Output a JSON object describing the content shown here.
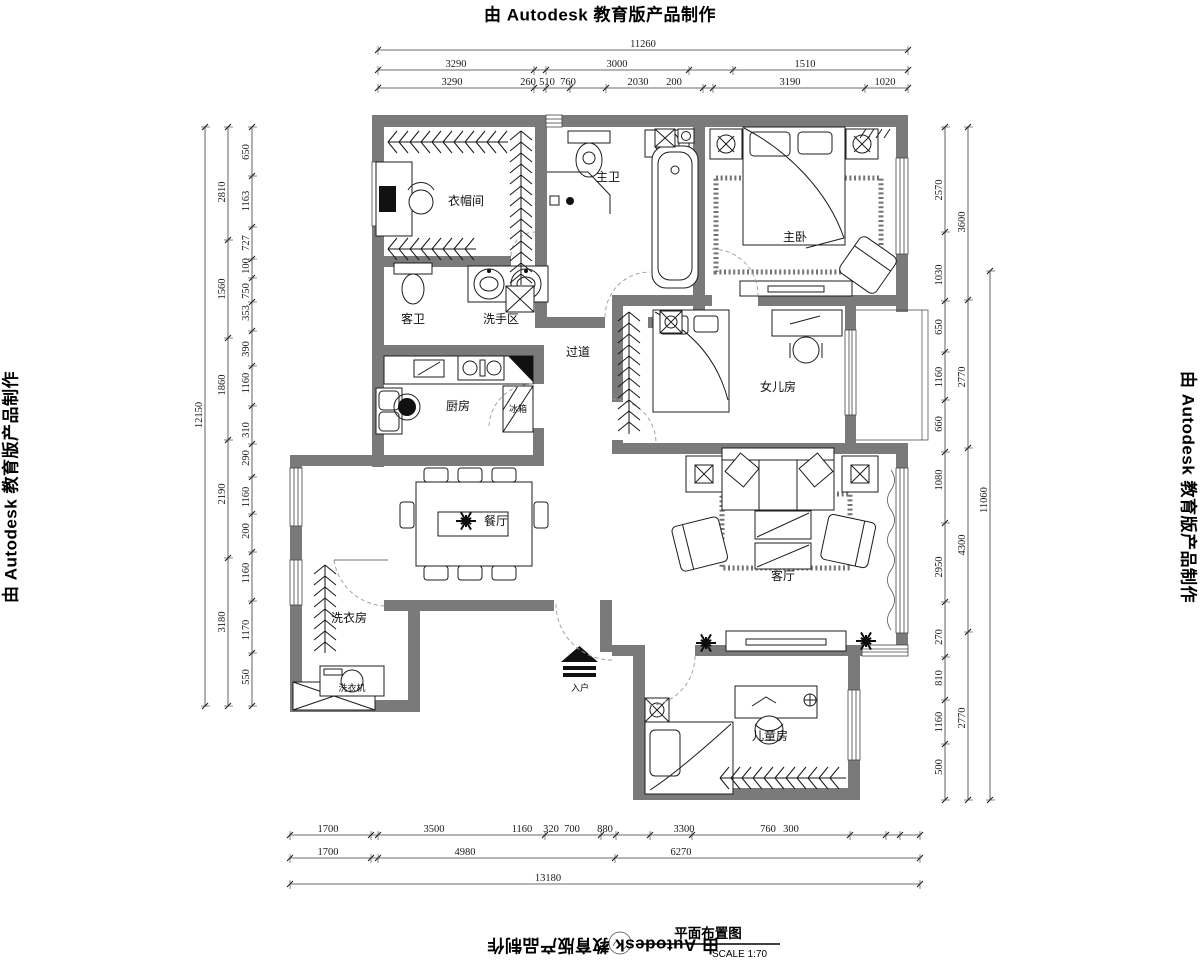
{
  "watermark": {
    "prefix": "由 ",
    "brand": "Autodesk",
    "suffix": " 教育版产品制作"
  },
  "title_block": {
    "title": "平面布置图",
    "scale_label": "SCALE 1:70"
  },
  "rooms": [
    {
      "id": "cloakroom",
      "label": "衣帽间",
      "x": 466,
      "y": 205
    },
    {
      "id": "master-bath",
      "label": "主卫",
      "x": 608,
      "y": 181
    },
    {
      "id": "master-bedroom",
      "label": "主卧",
      "x": 795,
      "y": 241
    },
    {
      "id": "guest-bath",
      "label": "客卫",
      "x": 413,
      "y": 323
    },
    {
      "id": "wash-area",
      "label": "洗手区",
      "x": 501,
      "y": 323
    },
    {
      "id": "hallway",
      "label": "过道",
      "x": 578,
      "y": 356
    },
    {
      "id": "kitchen",
      "label": "厨房",
      "x": 458,
      "y": 410
    },
    {
      "id": "daughter-room",
      "label": "女儿房",
      "x": 778,
      "y": 391
    },
    {
      "id": "dining-room",
      "label": "餐厅",
      "x": 496,
      "y": 525
    },
    {
      "id": "living-room",
      "label": "客厅",
      "x": 783,
      "y": 580
    },
    {
      "id": "laundry",
      "label": "洗衣房",
      "x": 349,
      "y": 622
    },
    {
      "id": "children-room",
      "label": "儿童房",
      "x": 770,
      "y": 740
    }
  ],
  "annotations": [
    {
      "id": "fridge",
      "label": "冰箱",
      "x": 518,
      "y": 412
    },
    {
      "id": "washer",
      "label": "洗衣机",
      "x": 352,
      "y": 691
    },
    {
      "id": "entry",
      "label": "入户",
      "x": 580,
      "y": 691
    }
  ],
  "dimensions": {
    "chains": [
      {
        "id": "top-total",
        "orient": "h",
        "line": 50,
        "ticks": [
          378,
          908
        ],
        "labels": [
          {
            "t": "11260",
            "x": 643
          }
        ]
      },
      {
        "id": "top-mid",
        "orient": "h",
        "line": 70,
        "ticks": [
          378,
          534,
          546,
          689,
          733,
          908
        ],
        "labels": [
          {
            "t": "3290",
            "x": 456
          },
          {
            "t": "3000",
            "x": 617
          },
          {
            "t": "1510",
            "x": 805
          }
        ]
      },
      {
        "id": "top-inner",
        "orient": "h",
        "line": 88,
        "ticks": [
          378,
          534,
          546,
          570,
          606,
          703,
          713,
          865,
          908
        ],
        "labels": [
          {
            "t": "3290",
            "x": 452
          },
          {
            "t": "260",
            "x": 528
          },
          {
            "t": "510",
            "x": 547
          },
          {
            "t": "760",
            "x": 568
          },
          {
            "t": "2030",
            "x": 638
          },
          {
            "t": "200",
            "x": 674
          },
          {
            "t": "3190",
            "x": 790
          },
          {
            "t": "1020",
            "x": 885
          }
        ]
      },
      {
        "id": "bottom-inner",
        "orient": "h",
        "line": 835,
        "ticks": [
          290,
          371,
          378,
          545,
          601,
          616,
          650,
          692,
          850,
          886,
          900,
          920
        ],
        "labels": [
          {
            "t": "1700",
            "x": 328
          },
          {
            "t": "3500",
            "x": 434
          },
          {
            "t": "1160",
            "x": 522
          },
          {
            "t": "320",
            "x": 551
          },
          {
            "t": "700",
            "x": 572
          },
          {
            "t": "880",
            "x": 605
          },
          {
            "t": "3300",
            "x": 684
          },
          {
            "t": "760",
            "x": 768
          },
          {
            "t": "300",
            "x": 791
          }
        ]
      },
      {
        "id": "bottom-mid",
        "orient": "h",
        "line": 858,
        "ticks": [
          290,
          371,
          378,
          615,
          920
        ],
        "labels": [
          {
            "t": "1700",
            "x": 328
          },
          {
            "t": "4980",
            "x": 465
          },
          {
            "t": "6270",
            "x": 681
          }
        ]
      },
      {
        "id": "bottom-total",
        "orient": "h",
        "line": 884,
        "ticks": [
          290,
          920
        ],
        "labels": [
          {
            "t": "13180",
            "x": 548
          }
        ]
      },
      {
        "id": "left-inner",
        "orient": "v",
        "line": 252,
        "ticks": [
          127,
          176,
          227,
          259,
          278,
          302,
          331,
          366,
          406,
          444,
          477,
          514,
          552,
          601,
          653,
          706
        ],
        "labels": [
          {
            "t": "650",
            "y": 152
          },
          {
            "t": "1163",
            "y": 201
          },
          {
            "t": "727",
            "y": 243
          },
          {
            "t": "100",
            "y": 266
          },
          {
            "t": "750",
            "y": 291
          },
          {
            "t": "353",
            "y": 313
          },
          {
            "t": "390",
            "y": 349
          },
          {
            "t": "1160",
            "y": 383
          },
          {
            "t": "310",
            "y": 430
          },
          {
            "t": "290",
            "y": 458
          },
          {
            "t": "1160",
            "y": 497
          },
          {
            "t": "200",
            "y": 531
          },
          {
            "t": "1160",
            "y": 573
          },
          {
            "t": "1170",
            "y": 630
          },
          {
            "t": "550",
            "y": 677
          }
        ]
      },
      {
        "id": "left-mid",
        "orient": "v",
        "line": 228,
        "ticks": [
          127,
          240,
          338,
          440,
          558,
          706
        ],
        "labels": [
          {
            "t": "2810",
            "y": 192
          },
          {
            "t": "1560",
            "y": 289
          },
          {
            "t": "1860",
            "y": 385
          },
          {
            "t": "2190",
            "y": 494
          },
          {
            "t": "3180",
            "y": 622
          }
        ]
      },
      {
        "id": "left-total",
        "orient": "v",
        "line": 205,
        "ticks": [
          127,
          706
        ],
        "labels": [
          {
            "t": "12150",
            "y": 415
          }
        ]
      },
      {
        "id": "right-inner",
        "orient": "v",
        "line": 945,
        "ticks": [
          127,
          232,
          301,
          352,
          400,
          452,
          523,
          602,
          657,
          700,
          744,
          800
        ],
        "labels": [
          {
            "t": "2570",
            "y": 190
          },
          {
            "t": "1030",
            "y": 275
          },
          {
            "t": "650",
            "y": 327
          },
          {
            "t": "1160",
            "y": 377
          },
          {
            "t": "660",
            "y": 424
          },
          {
            "t": "1080",
            "y": 480
          },
          {
            "t": "2950",
            "y": 567
          },
          {
            "t": "270",
            "y": 637
          },
          {
            "t": "810",
            "y": 678
          },
          {
            "t": "1160",
            "y": 722
          },
          {
            "t": "500",
            "y": 767
          }
        ]
      },
      {
        "id": "right-mid",
        "orient": "v",
        "line": 968,
        "ticks": [
          127,
          300,
          448,
          632,
          800
        ],
        "labels": [
          {
            "t": "3600",
            "y": 222
          },
          {
            "t": "2770",
            "y": 377
          },
          {
            "t": "4300",
            "y": 545
          },
          {
            "t": "2770",
            "y": 718
          }
        ]
      },
      {
        "id": "right-total",
        "orient": "v",
        "line": 990,
        "ticks": [
          271,
          800
        ],
        "labels": [
          {
            "t": "11060",
            "y": 500
          }
        ]
      }
    ]
  }
}
